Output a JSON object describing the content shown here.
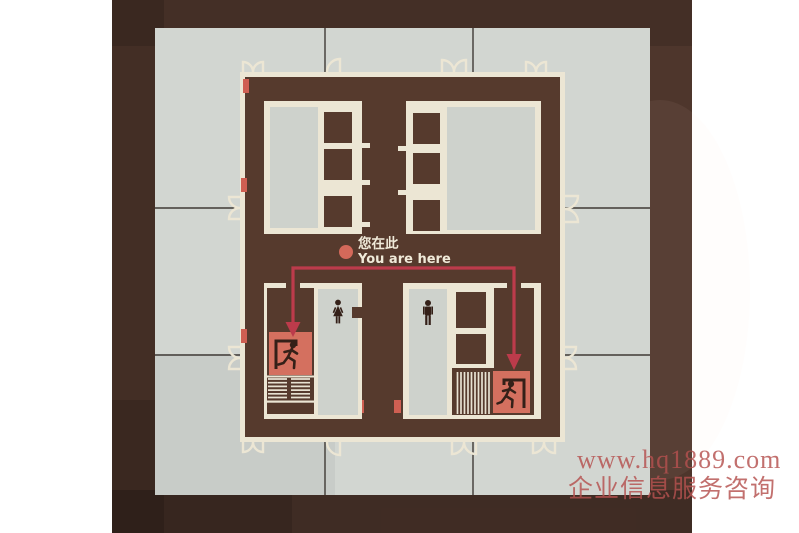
{
  "sign": {
    "you_are_here_zh": "您在此",
    "you_are_here_en": "You are here"
  },
  "watermark": {
    "line1": "www.hq1889.com",
    "line2": "企业信息服务咨询"
  },
  "colors": {
    "photo_background": "#4e362c",
    "sign_board": "#d2d6d1",
    "tile_seam": "#3f3a35",
    "plan_fill": "#563a2d",
    "wall_cream": "#ece6d4",
    "room_gray": "#ced2cc",
    "accent_salmon": "#d4705f",
    "route_red": "#bc3b4b",
    "pictogram_dark": "#342018",
    "label_cream": "#f0ead9",
    "watermark_red": "#b5514f"
  },
  "icons": {
    "you_are_here_dot": "salmon-circle",
    "exit_left": "running-man-in-doorway",
    "exit_right": "running-man-in-doorway",
    "stairs_left": "hatched-stair-treads",
    "stairs_right": "hatched-stair-treads",
    "restroom_female": "woman-pictogram",
    "restroom_male": "man-pictogram",
    "route": "down-arrows-evacuation-route"
  }
}
